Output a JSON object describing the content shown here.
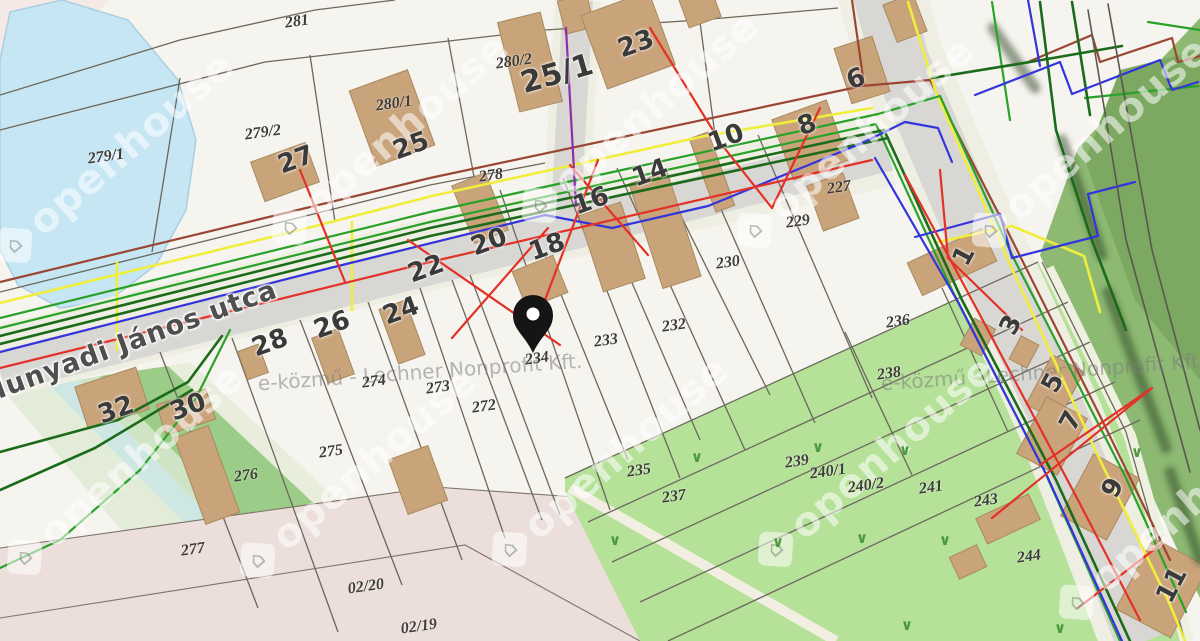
{
  "map": {
    "street_label": "Hunyadi János utca",
    "pin": {
      "parcel": "234"
    },
    "grass_symbol": "∨",
    "grass_marks": [
      [
        697,
        457
      ],
      [
        818,
        447
      ],
      [
        905,
        450
      ],
      [
        1137,
        452
      ],
      [
        862,
        538
      ],
      [
        945,
        540
      ],
      [
        778,
        542
      ],
      [
        907,
        625
      ],
      [
        1060,
        628
      ],
      [
        615,
        540
      ]
    ],
    "parcel_labels": [
      {
        "t": "281",
        "x": 297,
        "y": 22
      },
      {
        "t": "280/2",
        "x": 514,
        "y": 62
      },
      {
        "t": "280/1",
        "x": 394,
        "y": 104
      },
      {
        "t": "279/2",
        "x": 263,
        "y": 133
      },
      {
        "t": "279/1",
        "x": 106,
        "y": 157
      },
      {
        "t": "278",
        "x": 491,
        "y": 176
      },
      {
        "t": "227",
        "x": 839,
        "y": 188
      },
      {
        "t": "229",
        "x": 798,
        "y": 222
      },
      {
        "t": "230",
        "x": 728,
        "y": 263
      },
      {
        "t": "232",
        "x": 674,
        "y": 326
      },
      {
        "t": "233",
        "x": 606,
        "y": 341
      },
      {
        "t": "234",
        "x": 537,
        "y": 359
      },
      {
        "t": "235",
        "x": 639,
        "y": 471
      },
      {
        "t": "236",
        "x": 898,
        "y": 322
      },
      {
        "t": "237",
        "x": 674,
        "y": 497
      },
      {
        "t": "238",
        "x": 889,
        "y": 374
      },
      {
        "t": "239",
        "x": 797,
        "y": 462
      },
      {
        "t": "240/1",
        "x": 828,
        "y": 472
      },
      {
        "t": "240/2",
        "x": 866,
        "y": 486
      },
      {
        "t": "241",
        "x": 931,
        "y": 488
      },
      {
        "t": "243",
        "x": 986,
        "y": 501
      },
      {
        "t": "244",
        "x": 1029,
        "y": 557
      },
      {
        "t": "272",
        "x": 484,
        "y": 407
      },
      {
        "t": "273",
        "x": 438,
        "y": 388
      },
      {
        "t": "274",
        "x": 374,
        "y": 382
      },
      {
        "t": "275",
        "x": 331,
        "y": 452
      },
      {
        "t": "276",
        "x": 246,
        "y": 476
      },
      {
        "t": "277",
        "x": 193,
        "y": 550
      },
      {
        "t": "02/20",
        "x": 366,
        "y": 587
      },
      {
        "t": "02/19",
        "x": 419,
        "y": 627
      }
    ],
    "house_labels": [
      {
        "t": "27",
        "x": 296,
        "y": 160,
        "r": -20
      },
      {
        "t": "25",
        "x": 411,
        "y": 146,
        "r": -20
      },
      {
        "t": "25/1",
        "x": 557,
        "y": 74,
        "r": -16,
        "s": 30
      },
      {
        "t": "23",
        "x": 636,
        "y": 44,
        "r": -20
      },
      {
        "t": "22",
        "x": 426,
        "y": 269,
        "r": -20
      },
      {
        "t": "20",
        "x": 489,
        "y": 242,
        "r": -20
      },
      {
        "t": "18",
        "x": 547,
        "y": 247,
        "r": -20
      },
      {
        "t": "16",
        "x": 591,
        "y": 201,
        "r": -20
      },
      {
        "t": "14",
        "x": 650,
        "y": 173,
        "r": -20
      },
      {
        "t": "10",
        "x": 726,
        "y": 138,
        "r": -20
      },
      {
        "t": "8",
        "x": 807,
        "y": 125,
        "r": -20
      },
      {
        "t": "6",
        "x": 856,
        "y": 79,
        "r": -20
      },
      {
        "t": "24",
        "x": 401,
        "y": 311,
        "r": -20
      },
      {
        "t": "26",
        "x": 332,
        "y": 325,
        "r": -20
      },
      {
        "t": "28",
        "x": 270,
        "y": 343,
        "r": -20
      },
      {
        "t": "30",
        "x": 188,
        "y": 407,
        "r": -20
      },
      {
        "t": "32",
        "x": 116,
        "y": 410,
        "r": -20
      },
      {
        "t": "1",
        "x": 964,
        "y": 256,
        "r": -62
      },
      {
        "t": "3",
        "x": 1011,
        "y": 325,
        "r": -62
      },
      {
        "t": "5",
        "x": 1053,
        "y": 383,
        "r": -62
      },
      {
        "t": "7",
        "x": 1071,
        "y": 421,
        "r": -62
      },
      {
        "t": "9",
        "x": 1113,
        "y": 488,
        "r": -62
      },
      {
        "t": "11",
        "x": 1172,
        "y": 585,
        "r": -62
      }
    ]
  },
  "watermarks": {
    "brand_text": "openhouse",
    "brand_logo_glyph": "⌂",
    "brand_instances": [
      [
        115,
        158
      ],
      [
        390,
        140
      ],
      [
        640,
        118
      ],
      [
        855,
        143
      ],
      [
        1090,
        143
      ],
      [
        125,
        470
      ],
      [
        358,
        473
      ],
      [
        610,
        462
      ],
      [
        876,
        462
      ],
      [
        1177,
        515
      ]
    ],
    "provider_text": "e-közmű - Lechner Nonprofit Kft.",
    "provider_instances": [
      [
        420,
        372
      ],
      [
        1043,
        372
      ]
    ]
  },
  "palette": {
    "utility_red": "#e33127",
    "utility_blue": "#3434dd",
    "utility_green": "#2aa22a",
    "utility_dark_green": "#1b6b1b",
    "utility_yellow": "#f0ee3c",
    "utility_maroon": "#9a4632",
    "utility_purple": "#8d2fa8",
    "water": "#c6e6f4",
    "meadow_green": "#b5e198",
    "forest_green": "#8db973",
    "forest_dark": "#7ca861",
    "street_gray": "#d8d7d3",
    "road_pink": "#ecdeda",
    "building_tan": "#c9a47b",
    "parcel_fill": "#f6f4ef",
    "boundary_gray": "#6b685c",
    "pin_black": "#151515"
  }
}
